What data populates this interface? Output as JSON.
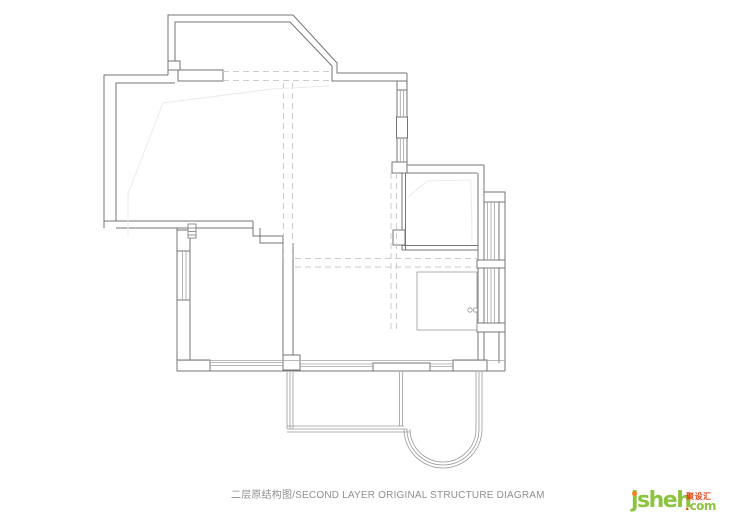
{
  "caption": {
    "text": "二层原结构图/SECOND LAYER ORIGINAL STRUCTURE DIAGRAM",
    "color": "#8f8f8f"
  },
  "logo": {
    "wordmark": "jsheh",
    "badge": "聚设汇",
    "domain_dot": ".",
    "domain_tld": "com",
    "colors": {
      "wordmark_green": "#8cc43f",
      "accent_orange": "#f5821f",
      "badge_red": "#e8400f"
    }
  },
  "plan": {
    "description": "second floor original structure floor plan line drawing",
    "colors": {
      "wall": "#757575",
      "window": "#a3a3a3",
      "thin_outline": "#9a9a9a",
      "dashed_beam": "#cbcbc9",
      "faint_ceiling": "#ebebe9",
      "background": "#ffffff"
    }
  }
}
